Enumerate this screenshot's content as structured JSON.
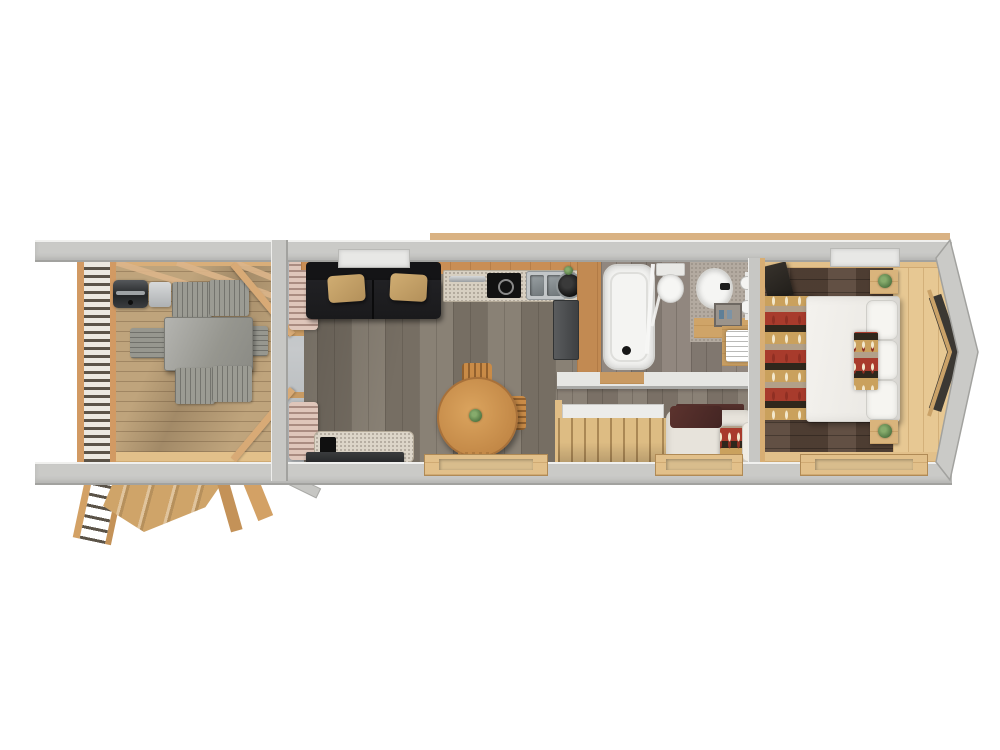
{
  "scene": {
    "type": "3d-floor-plan-top-view",
    "title": "Tiny house / park cabin floor plan, overhead 3D render on white background",
    "background": "#ffffff",
    "text_visible": "none"
  },
  "palette": {
    "wall_gray": "#cacac7",
    "wall_edge": "#a2a29f",
    "deck_wood": "#bfa47c",
    "orange_wood": "#c98e55",
    "pine_wood": "#e7c893",
    "living_floor": "#837a6e",
    "bedroom_floor": "#5a473a",
    "counter_granite": "#d7cfc1",
    "sofa_black": "#1d1d1f",
    "cushion_tan": "#c7a368",
    "rug_red": "#a83b2c",
    "rug_tan": "#caa15d",
    "rug_black": "#2f271c",
    "bed_white": "#f0eeea",
    "plant_green": "#4e7340",
    "table_wood": "#d1964f",
    "appliance_dark": "#1a1a1a",
    "steel": "#b9bcbe",
    "window_dark": "#3b3833"
  },
  "rooms": [
    {
      "label": "Covered deck",
      "furniture": [
        "bbq-grill",
        "outdoor-dining-table",
        "outdoor-chair x4",
        "outdoor-bench x2",
        "slatted-railing",
        "roof-beams",
        "entry-staircase"
      ]
    },
    {
      "label": "Living room and kitchen",
      "furniture": [
        "black-sofa",
        "tan-cushion x2",
        "tv-console",
        "flat-tv",
        "round-dining-table",
        "wooden-chair x2",
        "table-plant",
        "l-shaped-counter",
        "induction-hob",
        "double-sink",
        "corner-pot",
        "fridge",
        "curtains",
        "window-sill"
      ]
    },
    {
      "label": "Bathroom",
      "furniture": [
        "bathtub",
        "shower-glass-door",
        "toilet",
        "washbasin",
        "vanity-counter",
        "mirror-lights",
        "shelf",
        "towel-stack"
      ]
    },
    {
      "label": "Hallway",
      "furniture": [
        "loft-staircase",
        "cream-armchair",
        "dark-red-throw",
        "kilim-cushion"
      ]
    },
    {
      "label": "Bedroom",
      "furniture": [
        "double-bed",
        "white-pillow x3",
        "kilim-runner",
        "kilim-rug",
        "nightstand-with-plant x2",
        "wall-tv",
        "gable-end-window",
        "pine-platform",
        "window-sill"
      ]
    }
  ]
}
